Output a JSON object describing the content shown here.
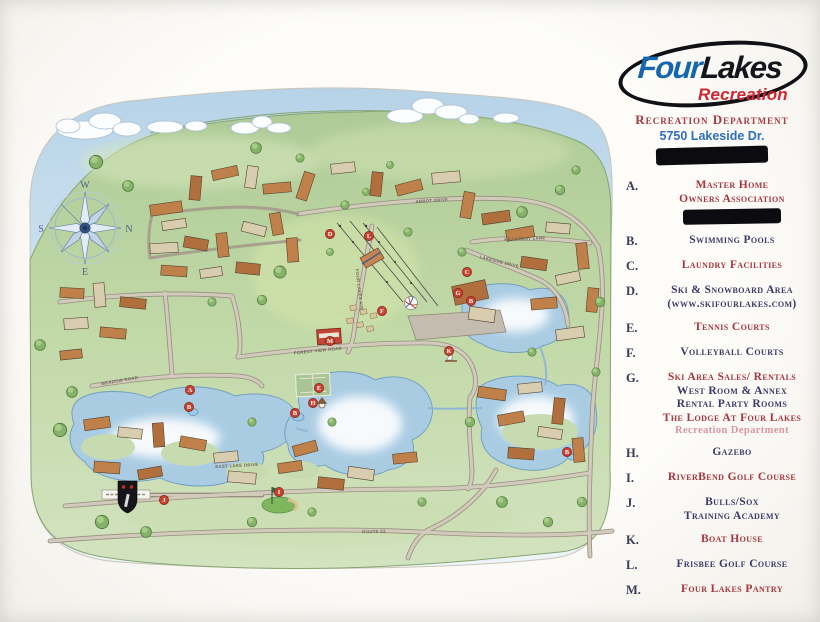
{
  "brand": {
    "four": "Four",
    "lakes": "Lakes",
    "recreation": "Recreation"
  },
  "header": {
    "department": "Recreation Department",
    "address": "5750 Lakeside Dr.",
    "redacted": true
  },
  "legend": {
    "items": [
      {
        "key": "A.",
        "lines": [
          {
            "text": "Master Home",
            "color": "red"
          },
          {
            "text": "Owners Association",
            "color": "red"
          }
        ],
        "redacted_after": true
      },
      {
        "key": "B.",
        "lines": [
          {
            "text": "Swimming Pools",
            "color": "navy"
          }
        ]
      },
      {
        "key": "C.",
        "lines": [
          {
            "text": "Laundry Facilities",
            "color": "red"
          }
        ]
      },
      {
        "key": "D.",
        "lines": [
          {
            "text": "Ski & Snowboard Area",
            "color": "navy"
          },
          {
            "text": "(www.skifourlakes.com)",
            "color": "navy"
          }
        ]
      },
      {
        "key": "E.",
        "lines": [
          {
            "text": "Tennis Courts",
            "color": "red"
          }
        ]
      },
      {
        "key": "F.",
        "lines": [
          {
            "text": "Volleyball Courts",
            "color": "navy"
          }
        ]
      },
      {
        "key": "G.",
        "lines": [
          {
            "text": "Ski Area Sales/ Rentals",
            "color": "red"
          },
          {
            "text": "West Room & Annex",
            "color": "navy"
          },
          {
            "text": "Rental Party Rooms",
            "color": "navy"
          },
          {
            "text": "The Lodge  At Four Lakes",
            "color": "red"
          },
          {
            "text": "Recreation Department",
            "color": "pink"
          }
        ]
      },
      {
        "key": "H.",
        "lines": [
          {
            "text": "Gazebo",
            "color": "navy"
          }
        ]
      },
      {
        "key": "I.",
        "lines": [
          {
            "text": "RiverBend Golf Course",
            "color": "red"
          }
        ]
      },
      {
        "key": "J.",
        "lines": [
          {
            "text": "Bulls/Sox",
            "color": "navy"
          },
          {
            "text": "Training Academy",
            "color": "navy"
          }
        ]
      },
      {
        "key": "K.",
        "lines": [
          {
            "text": "Boat House",
            "color": "red"
          }
        ]
      },
      {
        "key": "L.",
        "lines": [
          {
            "text": "Frisbee Golf Course",
            "color": "navy"
          }
        ]
      },
      {
        "key": "M.",
        "lines": [
          {
            "text": "Four Lakes Pantry",
            "color": "red"
          }
        ]
      }
    ]
  },
  "map": {
    "compass_points": [
      {
        "label": "W",
        "x": 85,
        "y": 188
      },
      {
        "label": "S",
        "x": 41,
        "y": 232
      },
      {
        "label": "N",
        "x": 129,
        "y": 232
      },
      {
        "label": "E",
        "x": 85,
        "y": 275
      }
    ],
    "markers": [
      {
        "letter": "D",
        "x": 330,
        "y": 234
      },
      {
        "letter": "L",
        "x": 369,
        "y": 236
      },
      {
        "letter": "M",
        "x": 330,
        "y": 341
      },
      {
        "letter": "F",
        "x": 382,
        "y": 311
      },
      {
        "letter": "C",
        "x": 467,
        "y": 272
      },
      {
        "letter": "G",
        "x": 458,
        "y": 293
      },
      {
        "letter": "B",
        "x": 471,
        "y": 301
      },
      {
        "letter": "K",
        "x": 449,
        "y": 351
      },
      {
        "letter": "A",
        "x": 190,
        "y": 390
      },
      {
        "letter": "B",
        "x": 189,
        "y": 407
      },
      {
        "letter": "E",
        "x": 319,
        "y": 388
      },
      {
        "letter": "H",
        "x": 313,
        "y": 403
      },
      {
        "letter": "B",
        "x": 295,
        "y": 413
      },
      {
        "letter": "B",
        "x": 567,
        "y": 452
      },
      {
        "letter": "J",
        "x": 164,
        "y": 500
      },
      {
        "letter": "I",
        "x": 279,
        "y": 492
      }
    ],
    "streets": [
      {
        "name": "Abbot Drive",
        "x": 432,
        "y": 202,
        "rot": -4
      },
      {
        "name": "Hillcrest Lane",
        "x": 525,
        "y": 240,
        "rot": -2
      },
      {
        "name": "Lakeside Drive",
        "x": 499,
        "y": 263,
        "rot": 14
      },
      {
        "name": "Four Lakes Ave",
        "x": 358,
        "y": 290,
        "rot": 83
      },
      {
        "name": "Forest View Road",
        "x": 318,
        "y": 352,
        "rot": -6
      },
      {
        "name": "Meadow Road",
        "x": 120,
        "y": 382,
        "rot": -10
      },
      {
        "name": "East Lake Drive",
        "x": 237,
        "y": 467,
        "rot": -3
      },
      {
        "name": "Route 53",
        "x": 374,
        "y": 533,
        "rot": -2
      }
    ]
  },
  "colors": {
    "legend_red": "#a8353c",
    "legend_navy": "#3a3a68",
    "legend_pink": "#db96a1",
    "brand_blue": "#1565b0",
    "brand_red": "#cf2630",
    "marker_red": "#c9412f"
  }
}
